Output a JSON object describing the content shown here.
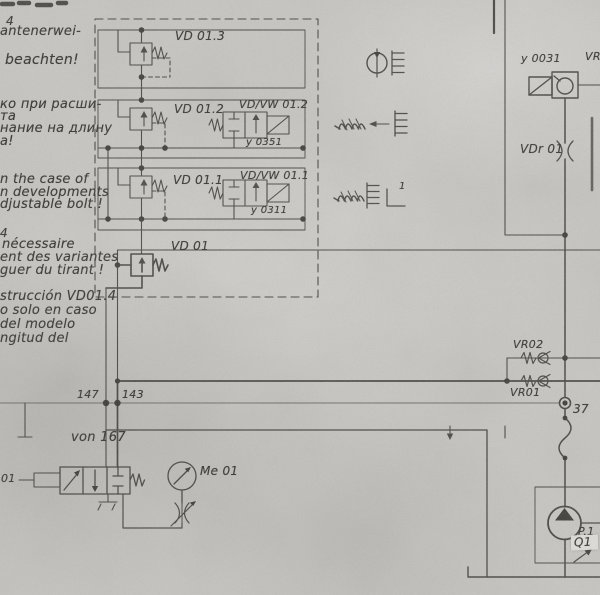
{
  "notes": {
    "german": [
      "4",
      "antenerwei-",
      "beachten!"
    ],
    "russian": [
      "ко при расши-",
      "та",
      "нание на длину",
      "а!"
    ],
    "english": [
      "n the case of",
      "n developments",
      "djustable bolt !"
    ],
    "french": [
      "4",
      "nécessaire",
      "ent des variantes",
      "guer du tirant !"
    ],
    "spanish": [
      "strucción VD01.4",
      "o solo en caso",
      "del modelo",
      "ngitud del"
    ]
  },
  "schematic": {
    "valve_group": {
      "vd013": "VD 01.3",
      "vd012": "VD 01.2",
      "vdvw012": "VD/VW 01.2",
      "y0351": "y 0351",
      "vd011": "VD 01.1",
      "vdvw011": "VD/VW 01.1",
      "y0311": "y 0311",
      "vd01": "VD 01"
    },
    "right_side": {
      "y0031": "y 0031",
      "vr_partial": "VR",
      "vdr01": "VDr 01",
      "vr02": "VR02",
      "vr01": "VR01",
      "point37": "37"
    },
    "bus": {
      "point147": "147",
      "point143": "143",
      "von167": "von 167",
      "left_cut_label": "01"
    },
    "bottom": {
      "me01": "Me 01",
      "p1": "P.1",
      "q1": "Q1"
    },
    "legend": {
      "superscript1": "1"
    }
  }
}
